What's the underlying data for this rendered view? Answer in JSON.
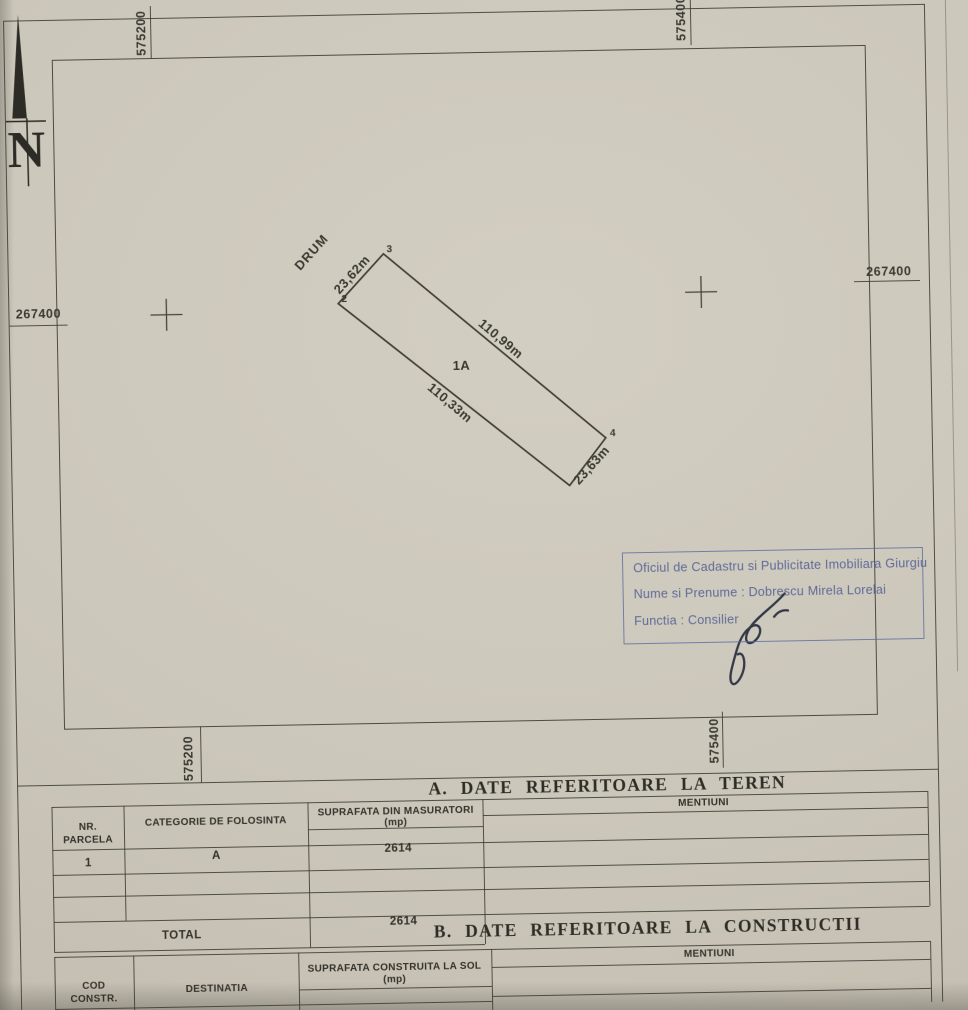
{
  "colors": {
    "paper": "#ccc7bb",
    "ink": "#3c3b34",
    "stamp_blue": "#5b6ca3"
  },
  "compass": {
    "north_label": "N"
  },
  "grid_labels": {
    "top_left": "575200",
    "top_right": "575400",
    "left": "267400",
    "right": "267400",
    "bottom_left": "575200",
    "bottom_right": "575400"
  },
  "plot": {
    "road_label": "DRUM",
    "parcel_label": "1A",
    "corner_2": "2",
    "corner_3": "3",
    "corner_4": "4",
    "dim_top_short": "23,62m",
    "dim_right_long": "110,99m",
    "dim_left_long": "110,33m",
    "dim_bottom_short": "23,63m"
  },
  "stamp": {
    "line1": "Oficiul de Cadastru si Publicitate Imobiliara Giurgiu",
    "line2": "Nume si Prenume : Dobrescu Mirela Lorelai",
    "line3": "Functia : Consilier"
  },
  "section_a": {
    "title": "A. DATE REFERITOARE LA TEREN",
    "col_nr_line1": "NR.",
    "col_nr_line2": "PARCELA",
    "col_categorie": "CATEGORIE DE FOLOSINTA",
    "col_suprafata": "SUPRAFATA DIN MASURATORI",
    "col_suprafata_unit": "(mp)",
    "col_mentiuni": "MENTIUNI",
    "row1": {
      "nr": "1",
      "categorie": "A",
      "suprafata": "2614"
    },
    "total_label": "TOTAL",
    "total_value": "2614"
  },
  "section_b": {
    "title": "B. DATE REFERITOARE LA CONSTRUCTII",
    "col_cod_line1": "COD",
    "col_cod_line2": "CONSTR.",
    "col_destinatia": "DESTINATIA",
    "col_suprafata": "SUPRAFATA CONSTRUITA LA SOL",
    "col_suprafata_unit": "(mp)",
    "col_mentiuni": "MENTIUNI"
  }
}
